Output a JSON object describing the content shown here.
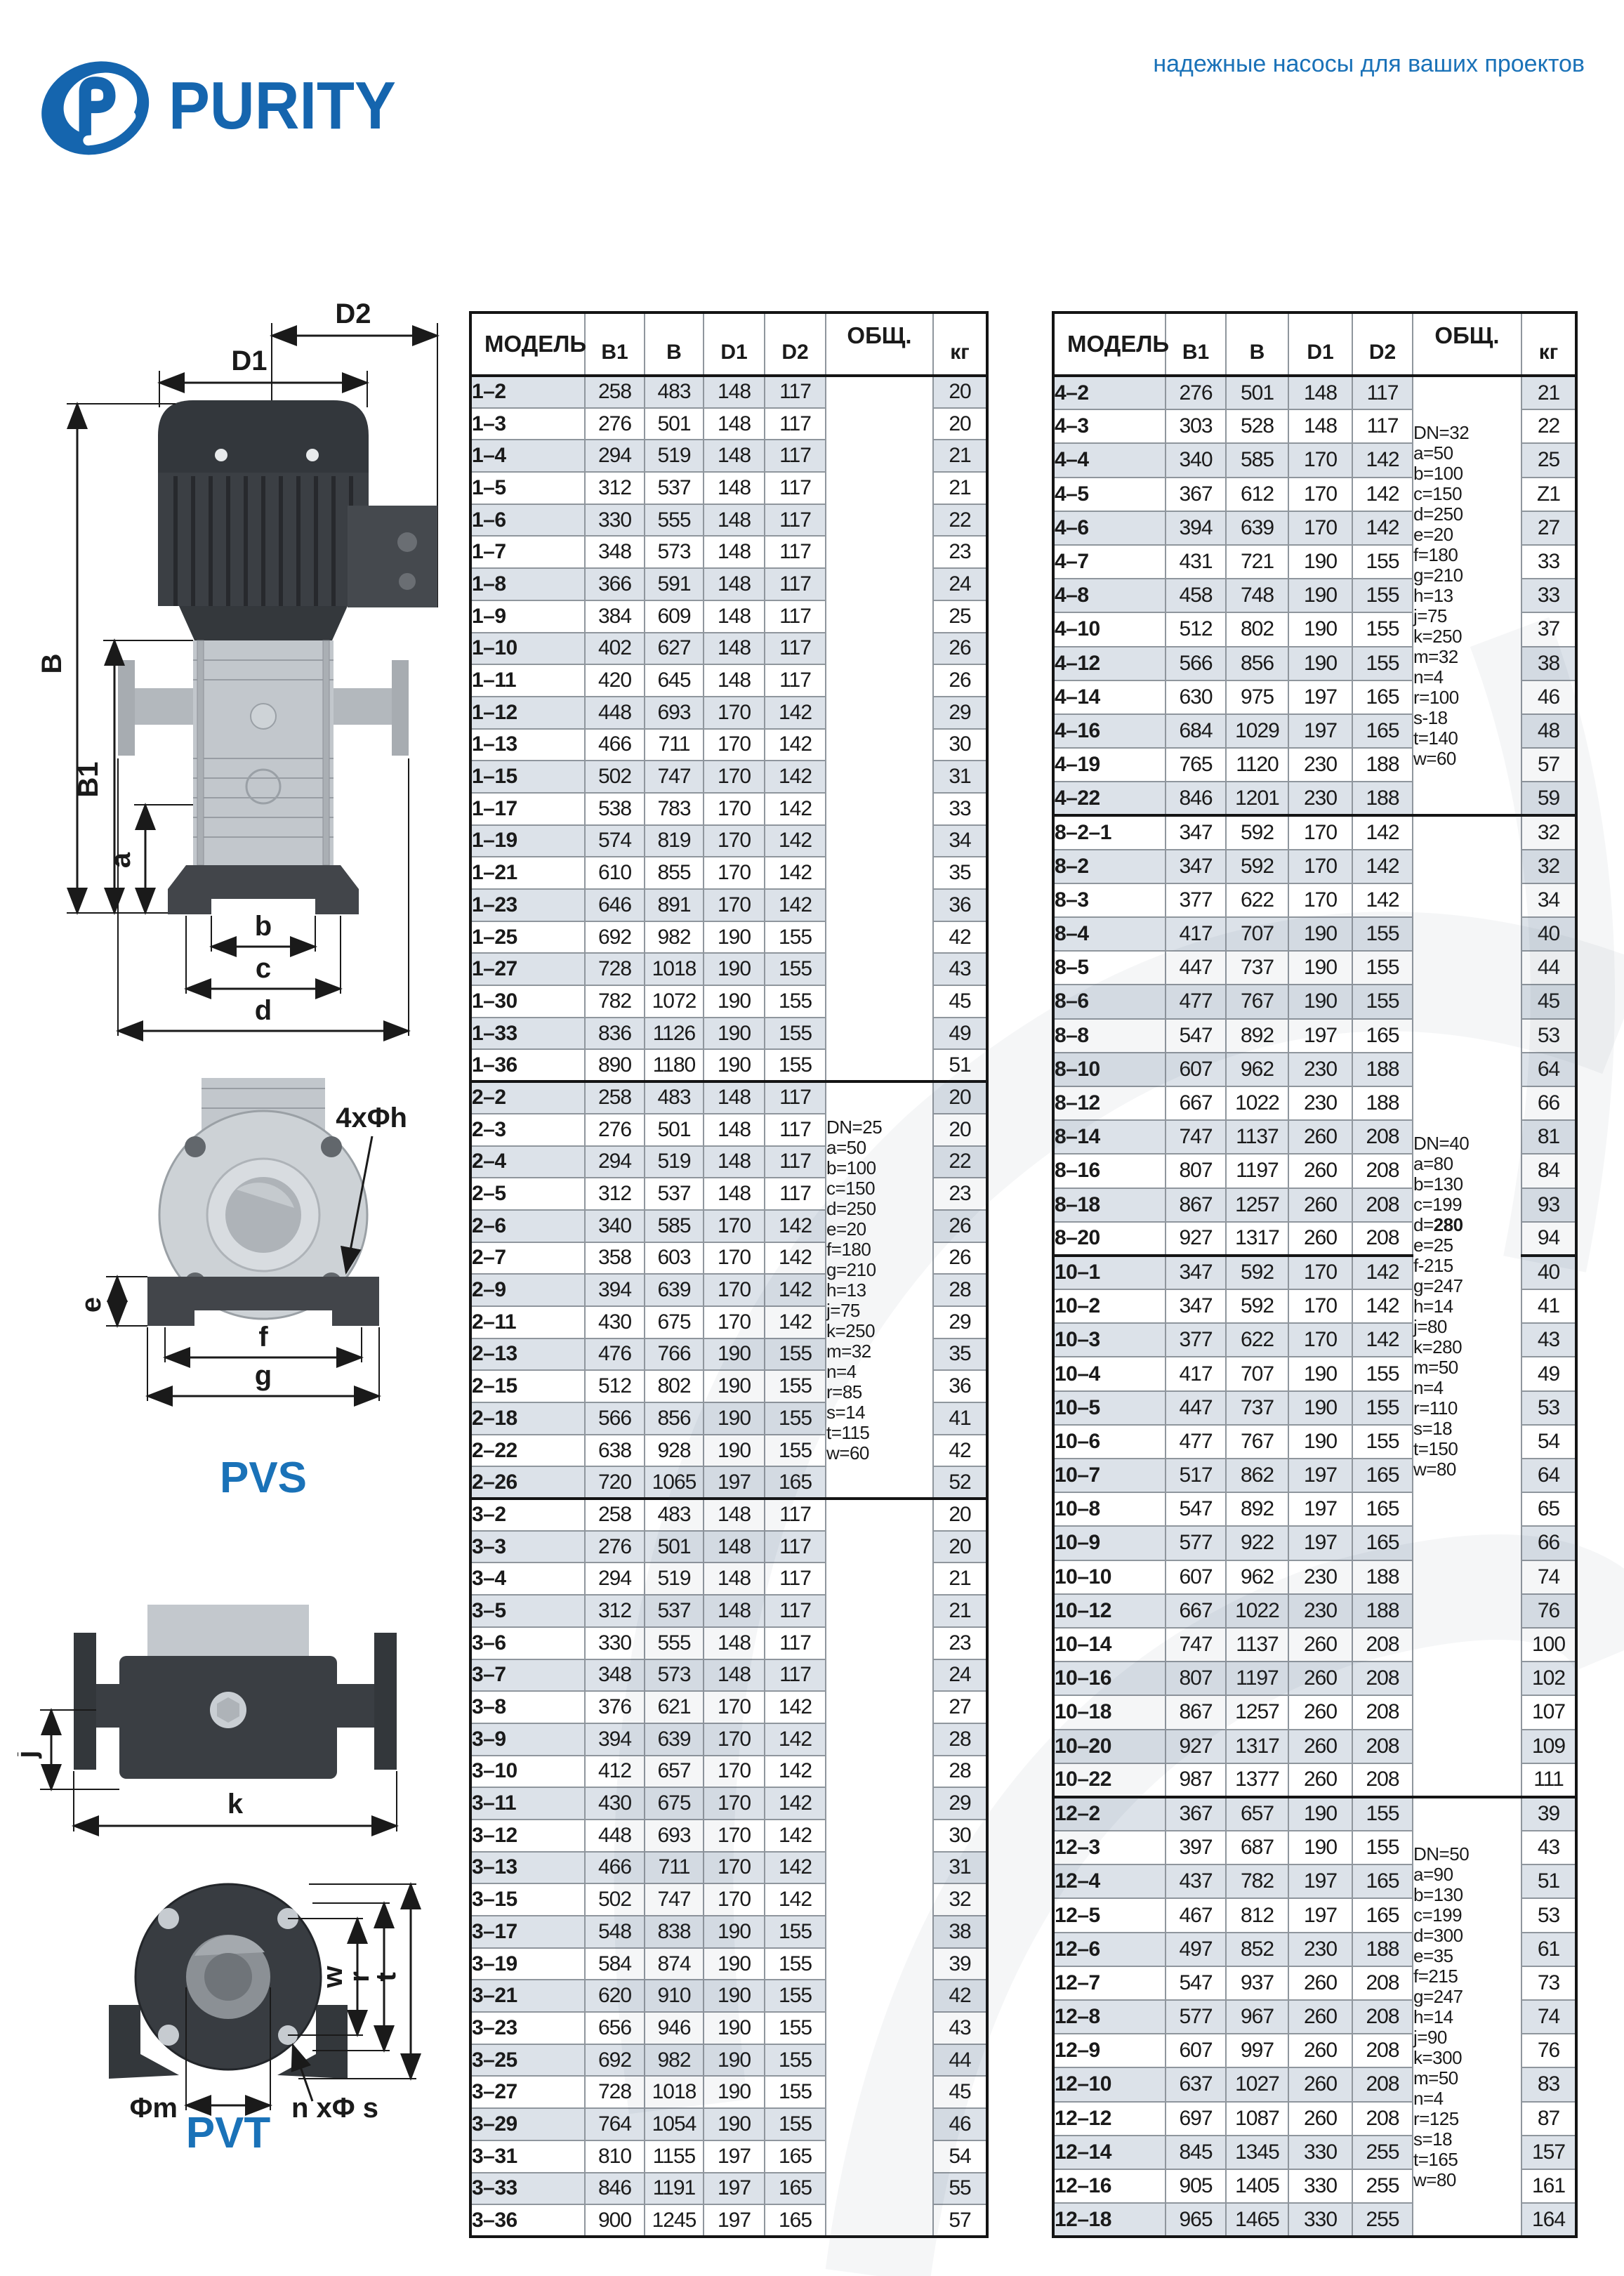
{
  "brand": {
    "logo_text": "PURITY",
    "tagline": "надежные насосы для ваших проектов",
    "accent_color": "#1a72b8"
  },
  "table_headers": {
    "model": "МОДЕЛЬ",
    "b1": "B1",
    "b": "B",
    "d1": "D1",
    "d2": "D2",
    "obsh": "ОБЩ.",
    "kg": "кг"
  },
  "diagrams": {
    "pvs": {
      "label": "PVS",
      "dims": {
        "d1": "D1",
        "d2": "D2",
        "b": "B",
        "b1": "B1",
        "a": "a",
        "b_base": "b",
        "c": "c",
        "d": "d",
        "e": "e",
        "f": "f",
        "g": "g",
        "bolt_callout": "4xΦh"
      }
    },
    "pvt": {
      "label": "PVT",
      "dims": {
        "j": "j",
        "k": "k",
        "w": "w",
        "r": "r",
        "t": "t",
        "m": "Φm",
        "bolt_callout": "n xΦ s"
      }
    }
  },
  "left_table": {
    "groups": [
      {
        "notes": [],
        "blocks": [
          [
            [
              "1–2",
              258,
              483,
              148,
              117,
              20
            ],
            [
              "1–3",
              276,
              501,
              148,
              117,
              20
            ],
            [
              "1–4",
              294,
              519,
              148,
              117,
              21
            ],
            [
              "1–5",
              312,
              537,
              148,
              117,
              21
            ],
            [
              "1–6",
              330,
              555,
              148,
              117,
              22
            ],
            [
              "1–7",
              348,
              573,
              148,
              117,
              23
            ],
            [
              "1–8",
              366,
              591,
              148,
              117,
              24
            ],
            [
              "1–9",
              384,
              609,
              148,
              117,
              25
            ],
            [
              "1–10",
              402,
              627,
              148,
              117,
              26
            ],
            [
              "1–11",
              420,
              645,
              148,
              117,
              26
            ],
            [
              "1–12",
              448,
              693,
              170,
              142,
              29
            ],
            [
              "1–13",
              466,
              711,
              170,
              142,
              30
            ],
            [
              "1–15",
              502,
              747,
              170,
              142,
              31
            ],
            [
              "1–17",
              538,
              783,
              170,
              142,
              33
            ],
            [
              "1–19",
              574,
              819,
              170,
              142,
              34
            ],
            [
              "1–21",
              610,
              855,
              170,
              142,
              35
            ],
            [
              "1–23",
              646,
              891,
              170,
              142,
              36
            ],
            [
              "1–25",
              692,
              982,
              190,
              155,
              42
            ],
            [
              "1–27",
              728,
              1018,
              190,
              155,
              43
            ],
            [
              "1–30",
              782,
              1072,
              190,
              155,
              45
            ],
            [
              "1–33",
              836,
              1126,
              190,
              155,
              49
            ],
            [
              "1–36",
              890,
              1180,
              190,
              155,
              51
            ]
          ]
        ]
      },
      {
        "notes": [
          "DN=25",
          "a=50",
          "b=100",
          "c=150",
          "d=250",
          "e=20",
          "f=180",
          "g=210",
          "h=13",
          "j=75",
          "k=250",
          "m=32",
          "n=4",
          "r=85",
          "s=14",
          "t=115",
          "w=60"
        ],
        "blocks": [
          [
            [
              "2–2",
              258,
              483,
              148,
              117,
              20
            ],
            [
              "2–3",
              276,
              501,
              148,
              117,
              20
            ],
            [
              "2–4",
              294,
              519,
              148,
              117,
              22
            ],
            [
              "2–5",
              312,
              537,
              148,
              117,
              23
            ],
            [
              "2–6",
              340,
              585,
              170,
              142,
              26
            ],
            [
              "2–7",
              358,
              603,
              170,
              142,
              26
            ],
            [
              "2–9",
              394,
              639,
              170,
              142,
              28
            ],
            [
              "2–11",
              430,
              675,
              170,
              142,
              29
            ],
            [
              "2–13",
              476,
              766,
              190,
              155,
              35
            ],
            [
              "2–15",
              512,
              802,
              190,
              155,
              36
            ],
            [
              "2–18",
              566,
              856,
              190,
              155,
              41
            ],
            [
              "2–22",
              638,
              928,
              190,
              155,
              42
            ],
            [
              "2–26",
              720,
              1065,
              197,
              165,
              52
            ]
          ]
        ]
      },
      {
        "notes": [],
        "blocks": [
          [
            [
              "3–2",
              258,
              483,
              148,
              117,
              20
            ],
            [
              "3–3",
              276,
              501,
              148,
              117,
              20
            ],
            [
              "3–4",
              294,
              519,
              148,
              117,
              21
            ],
            [
              "3–5",
              312,
              537,
              148,
              117,
              21
            ],
            [
              "3–6",
              330,
              555,
              148,
              117,
              23
            ],
            [
              "3–7",
              348,
              573,
              148,
              117,
              24
            ],
            [
              "3–8",
              376,
              621,
              170,
              142,
              27
            ],
            [
              "3–9",
              394,
              639,
              170,
              142,
              28
            ],
            [
              "3–10",
              412,
              657,
              170,
              142,
              28
            ],
            [
              "3–11",
              430,
              675,
              170,
              142,
              29
            ],
            [
              "3–12",
              448,
              693,
              170,
              142,
              30
            ],
            [
              "3–13",
              466,
              711,
              170,
              142,
              31
            ],
            [
              "3–15",
              502,
              747,
              170,
              142,
              32
            ],
            [
              "3–17",
              548,
              838,
              190,
              155,
              38
            ],
            [
              "3–19",
              584,
              874,
              190,
              155,
              39
            ],
            [
              "3–21",
              620,
              910,
              190,
              155,
              42
            ],
            [
              "3–23",
              656,
              946,
              190,
              155,
              43
            ],
            [
              "3–25",
              692,
              982,
              190,
              155,
              44
            ],
            [
              "3–27",
              728,
              1018,
              190,
              155,
              45
            ],
            [
              "3–29",
              764,
              1054,
              190,
              155,
              46
            ],
            [
              "3–31",
              810,
              1155,
              197,
              165,
              54
            ],
            [
              "3–33",
              846,
              1191,
              197,
              165,
              55
            ],
            [
              "3–36",
              900,
              1245,
              197,
              165,
              57
            ]
          ]
        ]
      }
    ]
  },
  "right_table": {
    "groups": [
      {
        "notes": [
          "DN=32",
          "a=50",
          "b=100",
          "c=150",
          "d=250",
          "e=20",
          "f=180",
          "g=210",
          "h=13",
          "j=75",
          "k=250",
          "m=32",
          "n=4",
          "r=100",
          "s-18",
          "t=140",
          "w=60"
        ],
        "blocks": [
          [
            [
              "4–2",
              276,
              501,
              148,
              117,
              21
            ],
            [
              "4–3",
              303,
              528,
              148,
              117,
              22
            ],
            [
              "4–4",
              340,
              585,
              170,
              142,
              25
            ],
            [
              "4–5",
              367,
              612,
              170,
              142,
              "Z1"
            ],
            [
              "4–6",
              394,
              639,
              170,
              142,
              27
            ],
            [
              "4–7",
              431,
              721,
              190,
              155,
              33
            ],
            [
              "4–8",
              458,
              748,
              190,
              155,
              33
            ],
            [
              "4–10",
              512,
              802,
              190,
              155,
              37
            ],
            [
              "4–12",
              566,
              856,
              190,
              155,
              38
            ],
            [
              "4–14",
              630,
              975,
              197,
              165,
              46
            ],
            [
              "4–16",
              684,
              1029,
              197,
              165,
              48
            ],
            [
              "4–19",
              765,
              1120,
              230,
              188,
              57
            ],
            [
              "4–22",
              846,
              1201,
              230,
              188,
              59
            ]
          ]
        ]
      },
      {
        "notes": [
          "DN=40",
          "a=80",
          "b=130",
          "c=199",
          "d=280",
          "e=25",
          "f-215",
          "g=247",
          "h=14",
          "j=80",
          "k=280",
          "m=50",
          "n=4",
          "r=110",
          "s=18",
          "t=150",
          "w=80"
        ],
        "bold_note": "d=280",
        "blocks": [
          [
            [
              "8–2–1",
              347,
              592,
              170,
              142,
              32
            ],
            [
              "8–2",
              347,
              592,
              170,
              142,
              32
            ],
            [
              "8–3",
              377,
              622,
              170,
              142,
              34
            ],
            [
              "8–4",
              417,
              707,
              190,
              155,
              40
            ],
            [
              "8–5",
              447,
              737,
              190,
              155,
              44
            ],
            [
              "8–6",
              477,
              767,
              190,
              155,
              45
            ],
            [
              "8–8",
              547,
              892,
              197,
              165,
              53
            ],
            [
              "8–10",
              607,
              962,
              230,
              188,
              64
            ],
            [
              "8–12",
              667,
              1022,
              230,
              188,
              66
            ],
            [
              "8–14",
              747,
              1137,
              260,
              208,
              81
            ],
            [
              "8–16",
              807,
              1197,
              260,
              208,
              84
            ],
            [
              "8–18",
              867,
              1257,
              260,
              208,
              93
            ],
            [
              "8–20",
              927,
              1317,
              260,
              208,
              94
            ]
          ],
          [
            [
              "10–1",
              347,
              592,
              170,
              142,
              40
            ],
            [
              "10–2",
              347,
              592,
              170,
              142,
              41
            ],
            [
              "10–3",
              377,
              622,
              170,
              142,
              43
            ],
            [
              "10–4",
              417,
              707,
              190,
              155,
              49
            ],
            [
              "10–5",
              447,
              737,
              190,
              155,
              53
            ],
            [
              "10–6",
              477,
              767,
              190,
              155,
              54
            ],
            [
              "10–7",
              517,
              862,
              197,
              165,
              64
            ],
            [
              "10–8",
              547,
              892,
              197,
              165,
              65
            ],
            [
              "10–9",
              577,
              922,
              197,
              165,
              66
            ],
            [
              "10–10",
              607,
              962,
              230,
              188,
              74
            ],
            [
              "10–12",
              667,
              1022,
              230,
              188,
              76
            ],
            [
              "10–14",
              747,
              1137,
              260,
              208,
              100
            ],
            [
              "10–16",
              807,
              1197,
              260,
              208,
              102
            ],
            [
              "10–18",
              867,
              1257,
              260,
              208,
              107
            ],
            [
              "10–20",
              927,
              1317,
              260,
              208,
              109
            ],
            [
              "10–22",
              987,
              1377,
              260,
              208,
              111
            ]
          ]
        ]
      },
      {
        "notes": [
          "DN=50",
          "a=90",
          "b=130",
          "c=199",
          "d=300",
          "e=35",
          "f=215",
          "g=247",
          "h=14",
          "j=90",
          "k=300",
          "m=50",
          "n=4",
          "r=125",
          "s=18",
          "t=165",
          "w=80"
        ],
        "blocks": [
          [
            [
              "12–2",
              367,
              657,
              190,
              155,
              39
            ],
            [
              "12–3",
              397,
              687,
              190,
              155,
              43
            ],
            [
              "12–4",
              437,
              782,
              197,
              165,
              51
            ],
            [
              "12–5",
              467,
              812,
              197,
              165,
              53
            ],
            [
              "12–6",
              497,
              852,
              230,
              188,
              61
            ],
            [
              "12–7",
              547,
              937,
              260,
              208,
              73
            ],
            [
              "12–8",
              577,
              967,
              260,
              208,
              74
            ],
            [
              "12–9",
              607,
              997,
              260,
              208,
              76
            ],
            [
              "12–10",
              637,
              1027,
              260,
              208,
              83
            ],
            [
              "12–12",
              697,
              1087,
              260,
              208,
              87
            ],
            [
              "12–14",
              845,
              1345,
              330,
              255,
              157
            ],
            [
              "12–16",
              905,
              1405,
              330,
              255,
              161
            ],
            [
              "12–18",
              965,
              1465,
              330,
              255,
              164
            ]
          ]
        ]
      }
    ]
  }
}
